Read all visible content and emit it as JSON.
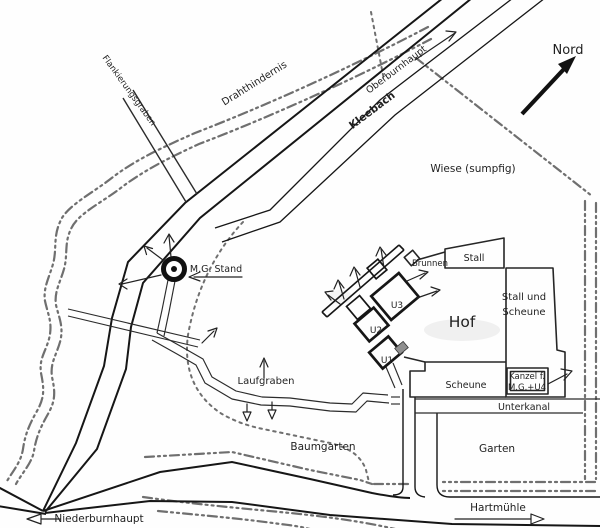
{
  "colors": {
    "ink": "#161616",
    "boundary": "#6f6f6f",
    "paper": "#fefefe"
  },
  "compass": {
    "north_label": "Nord"
  },
  "terrain": {
    "wiese": "Wiese (sumpfig)"
  },
  "waterways": {
    "kleebach": "Kleebach",
    "unterkanal": "Unterkanal"
  },
  "roads": {
    "oberburnhaupt": "Oberburnhaupt",
    "niederburnhaupt": "Niederburnhaupt",
    "hartmuehle": "Hartmühle"
  },
  "defenses": {
    "drahthindernis": "Drahthindernis",
    "flankierungsgraben": "Flankierungsgraben",
    "laufgraben": "Laufgraben",
    "mg_stand": "M.G. Stand",
    "kanzel_line1": "Kanzel f.",
    "kanzel_line2": "M.G.+U4",
    "u1": "U1",
    "u2": "U2",
    "u3": "U3"
  },
  "farm": {
    "hof": "Hof",
    "stall": "Stall",
    "stall_und_scheune_line1": "Stall und",
    "stall_und_scheune_line2": "Scheune",
    "scheune": "Scheune",
    "brunnen": "Brunnen",
    "garten": "Garten",
    "baumgarten": "Baumgarten"
  }
}
